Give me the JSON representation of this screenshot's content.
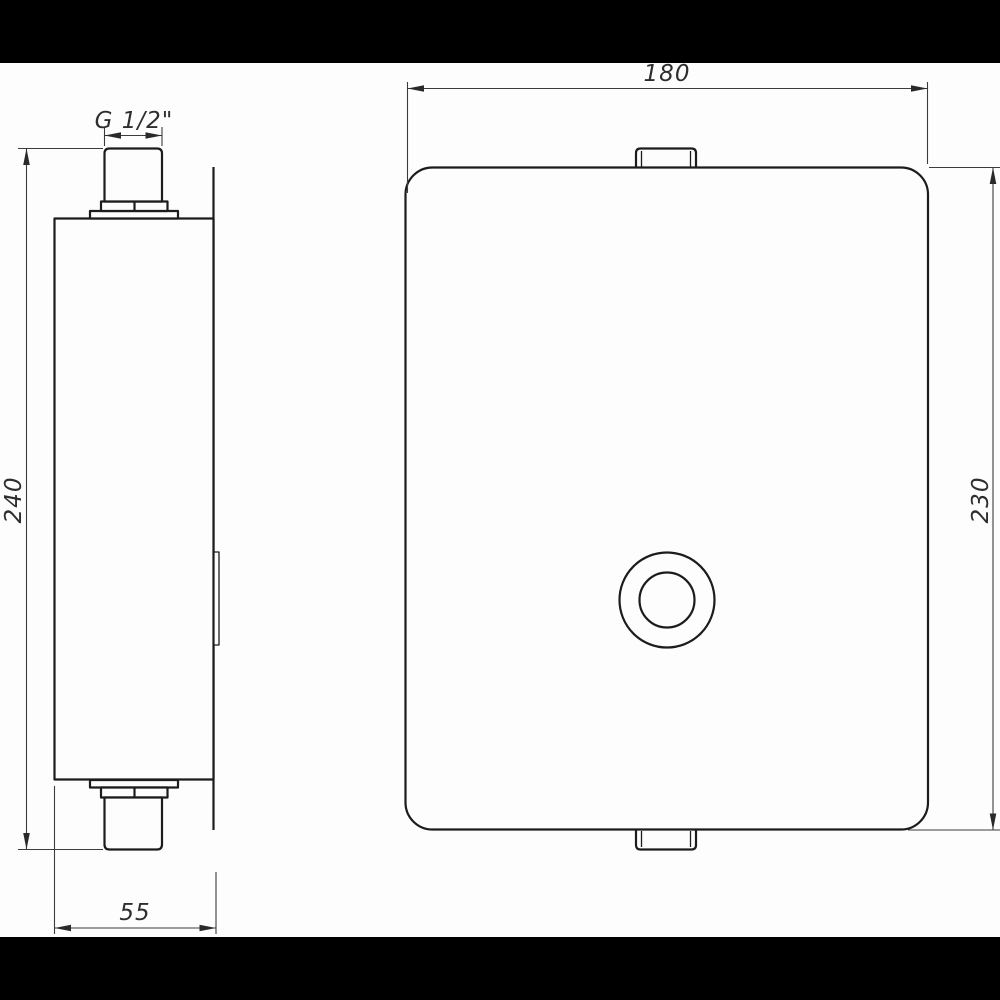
{
  "colors": {
    "paper": "#fdfdfd",
    "letterbox": "#000000",
    "object_line": "#1c1c1c",
    "dimension_line": "#3c3c3c"
  },
  "drawing": {
    "dimensions": {
      "thread_size": "G 1/2\"",
      "side_height": "240",
      "side_depth": "55",
      "front_width": "180",
      "front_height": "230"
    }
  }
}
